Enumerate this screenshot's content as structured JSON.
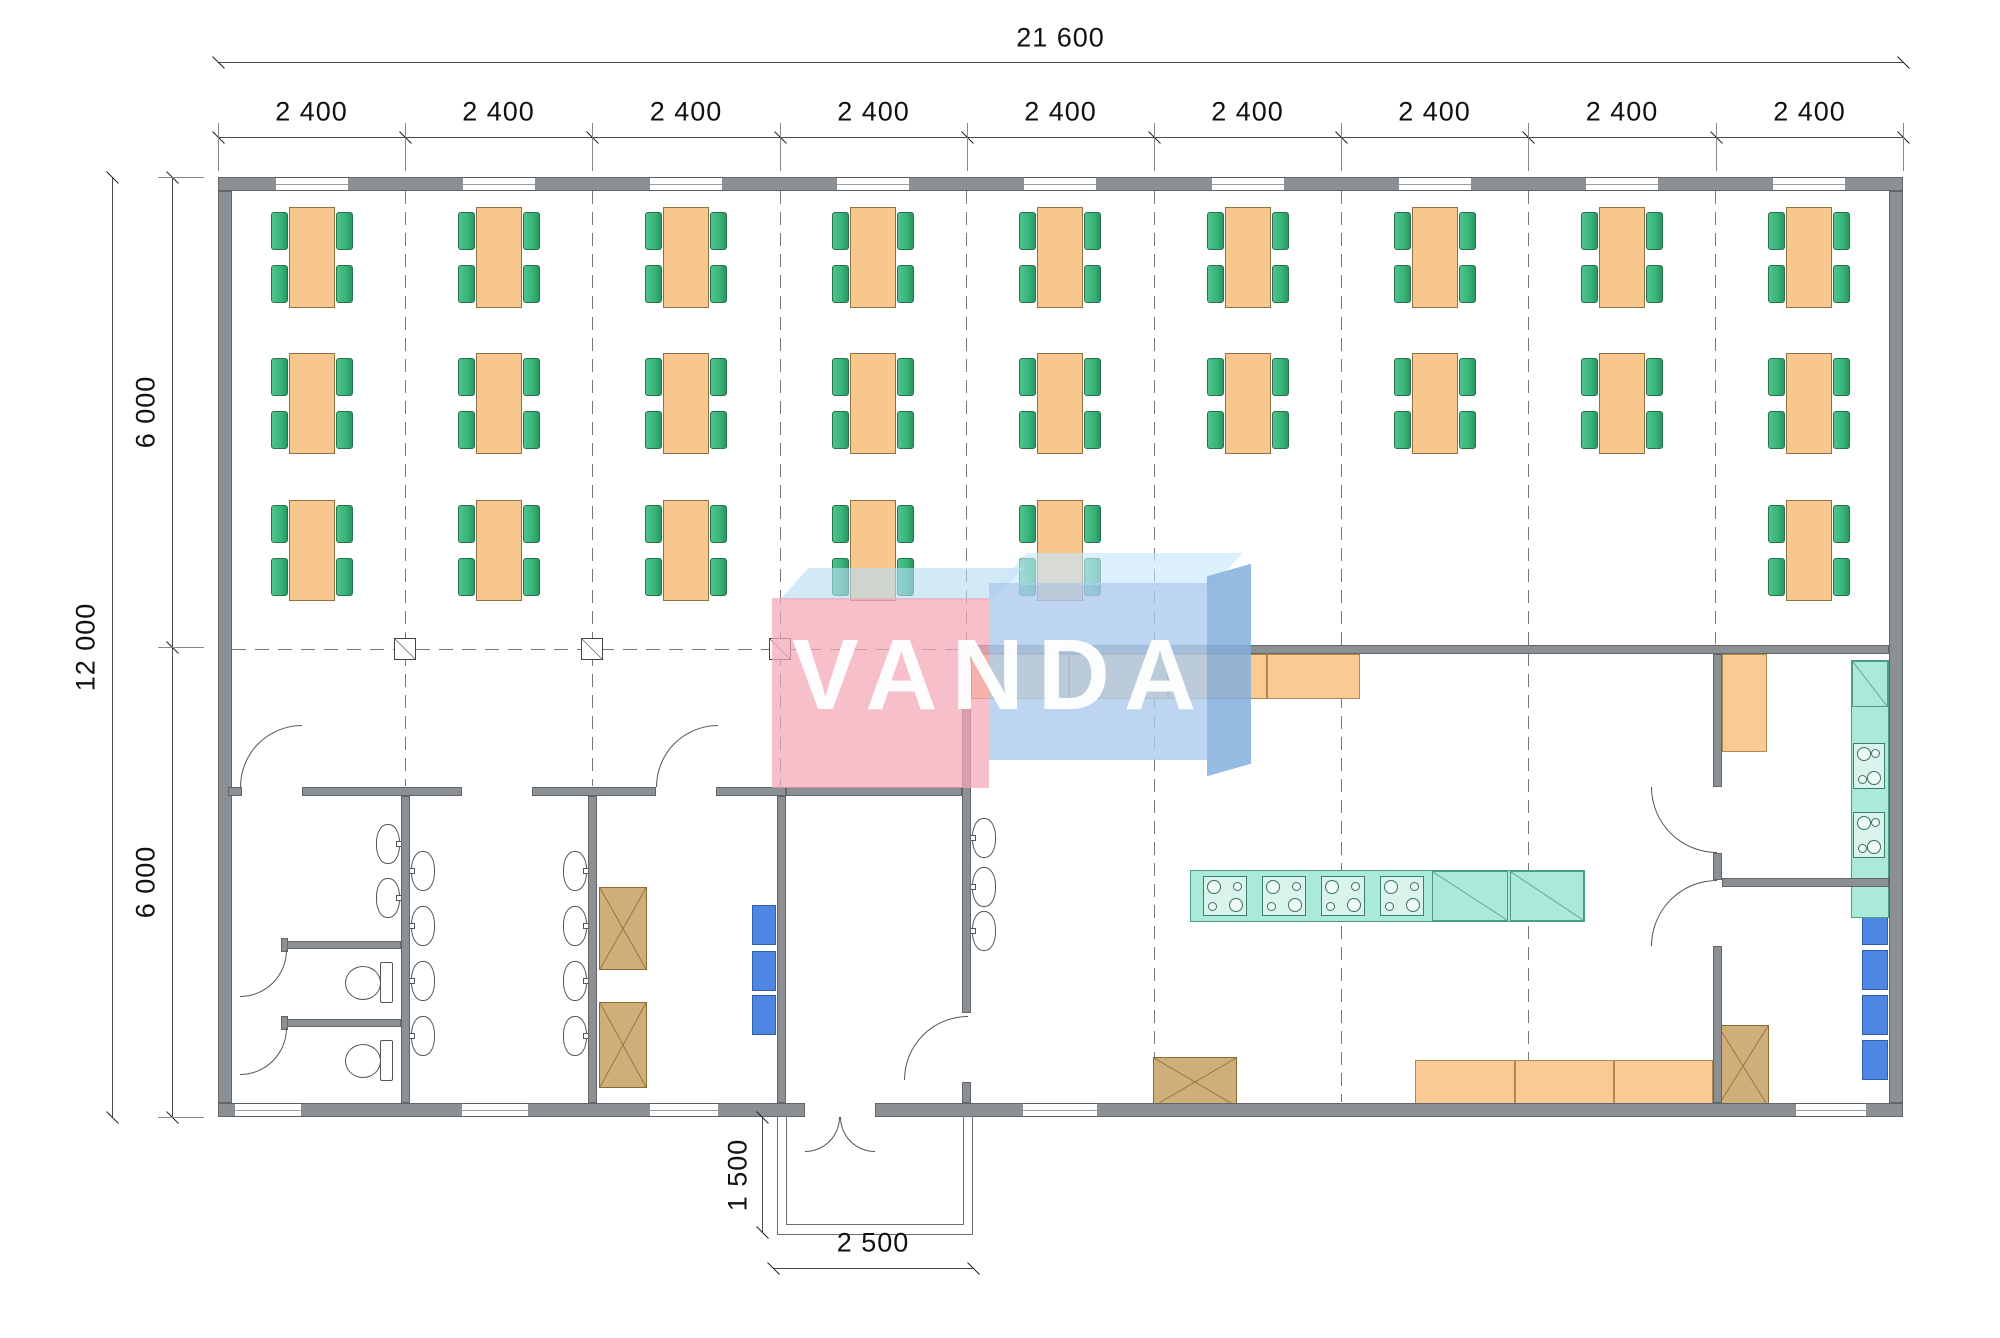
{
  "watermark": {
    "text": "VANDA"
  },
  "dimensions": {
    "total_width": "21 600",
    "bay_label": "2 400",
    "bay_labels": [
      "2 400",
      "2 400",
      "2 400",
      "2 400",
      "2 400",
      "2 400",
      "2 400",
      "2 400",
      "2 400"
    ],
    "total_height": "12 000",
    "half_labels": [
      "6 000",
      "6 000"
    ],
    "porch_depth": "1 500",
    "porch_width": "2 500"
  },
  "colors": {
    "wall": "#8b9094",
    "table": "#f7c78e",
    "chair": "#3bb57c",
    "teal": "#abe9d9",
    "cabinet": "#cfae79",
    "locker_blue": "#4f86e3",
    "counter": "#f9cb92",
    "watermark_pink": "#f2a6b6",
    "watermark_blue": "#adcbec"
  },
  "plan": {
    "walls": [
      [
        218,
        177,
        1685,
        14
      ],
      [
        218,
        1103,
        587,
        14
      ],
      [
        875,
        1103,
        1028,
        14
      ],
      [
        218,
        191,
        14,
        912
      ],
      [
        1889,
        191,
        14,
        912
      ],
      [
        962,
        645,
        927,
        9
      ],
      [
        228,
        787,
        14,
        9
      ],
      [
        302,
        787,
        160,
        9
      ],
      [
        532,
        787,
        124,
        9
      ],
      [
        716,
        787,
        70,
        9
      ],
      [
        786,
        787,
        176,
        9
      ],
      [
        401,
        796,
        9,
        307
      ],
      [
        588,
        796,
        9,
        307
      ],
      [
        777,
        796,
        9,
        307
      ],
      [
        962,
        654,
        9,
        359
      ],
      [
        962,
        1082,
        9,
        21
      ],
      [
        1713,
        654,
        9,
        133
      ],
      [
        1713,
        853,
        9,
        27
      ],
      [
        1713,
        946,
        9,
        157
      ],
      [
        1722,
        878,
        167,
        9
      ],
      [
        287,
        941,
        114,
        8
      ],
      [
        287,
        1019,
        114,
        8
      ],
      [
        281,
        938,
        7,
        14
      ],
      [
        281,
        1016,
        7,
        14
      ]
    ],
    "windows_top": {
      "centers": [
        312,
        499,
        686,
        873,
        1060,
        1248,
        1435,
        1622,
        1809
      ],
      "w": 72,
      "y": 177,
      "h": 14
    },
    "windows_bottom": [
      [
        235,
        1103,
        66
      ],
      [
        462,
        1103,
        66
      ],
      [
        650,
        1103,
        68
      ],
      [
        1023,
        1103,
        74
      ],
      [
        1796,
        1103,
        70
      ]
    ],
    "dashed_v": [
      {
        "x": 405,
        "y1": 191,
        "y2": 786
      },
      {
        "x": 592,
        "y1": 191,
        "y2": 786
      },
      {
        "x": 780,
        "y1": 191,
        "y2": 786
      },
      {
        "x": 966,
        "y1": 191,
        "y2": 644
      },
      {
        "x": 1154,
        "y1": 191,
        "y2": 1102
      },
      {
        "x": 1341,
        "y1": 191,
        "y2": 1102
      },
      {
        "x": 1528,
        "y1": 191,
        "y2": 1102
      },
      {
        "x": 1715,
        "y1": 191,
        "y2": 644
      }
    ],
    "dashed_h": {
      "y": 649,
      "x1": 232,
      "x2": 961
    },
    "columns": [
      405,
      592,
      780
    ],
    "tables": {
      "bay_centers": [
        312,
        499,
        686,
        873,
        1060,
        1248,
        1435,
        1622,
        1809
      ],
      "row_tops": [
        207,
        353,
        500
      ],
      "grid": [
        [
          1,
          1,
          1
        ],
        [
          1,
          1,
          1
        ],
        [
          1,
          1,
          1
        ],
        [
          1,
          1,
          1
        ],
        [
          1,
          1,
          1
        ],
        [
          1,
          1,
          0
        ],
        [
          1,
          1,
          0
        ],
        [
          1,
          1,
          0
        ],
        [
          1,
          1,
          1
        ]
      ],
      "table_w": 46,
      "table_h": 101,
      "chair_w": 17,
      "chair_h": 38
    },
    "sinks": [
      {
        "x": 376,
        "y": 824,
        "tap": "right"
      },
      {
        "x": 376,
        "y": 878,
        "tap": "right"
      },
      {
        "x": 411,
        "y": 851,
        "tap": "left"
      },
      {
        "x": 411,
        "y": 906,
        "tap": "left"
      },
      {
        "x": 411,
        "y": 961,
        "tap": "left"
      },
      {
        "x": 411,
        "y": 1016,
        "tap": "left"
      },
      {
        "x": 563,
        "y": 851,
        "tap": "right"
      },
      {
        "x": 563,
        "y": 906,
        "tap": "right"
      },
      {
        "x": 563,
        "y": 961,
        "tap": "right"
      },
      {
        "x": 563,
        "y": 1016,
        "tap": "right"
      },
      {
        "x": 972,
        "y": 818,
        "tap": "left"
      },
      {
        "x": 972,
        "y": 867,
        "tap": "left"
      },
      {
        "x": 972,
        "y": 911,
        "tap": "left"
      }
    ],
    "toilets": [
      {
        "x": 345,
        "y": 963
      },
      {
        "x": 345,
        "y": 1041
      }
    ],
    "x_cabinets": [
      [
        599,
        887,
        48,
        83
      ],
      [
        599,
        1002,
        48,
        86
      ],
      [
        1153,
        1057,
        84,
        50
      ],
      [
        1717,
        1025,
        52,
        82
      ]
    ],
    "blue_units": [
      [
        752,
        905,
        24,
        40
      ],
      [
        752,
        951,
        24,
        40
      ],
      [
        752,
        995,
        24,
        40
      ],
      [
        1862,
        905,
        26,
        40
      ],
      [
        1862,
        950,
        26,
        40
      ],
      [
        1862,
        995,
        26,
        40
      ],
      [
        1862,
        1040,
        26,
        40
      ]
    ],
    "counters": [
      {
        "x": 971,
        "y": 654,
        "w": 389,
        "h": 45,
        "dividers": [
          1068,
          1167,
          1266
        ],
        "vdiv": true
      },
      {
        "x": 1415,
        "y": 1060,
        "w": 298,
        "h": 47,
        "dividers": [
          1514,
          1613
        ],
        "vdiv": true
      },
      {
        "x": 1722,
        "y": 654,
        "w": 45,
        "h": 98,
        "dividers": [],
        "vdiv": false
      }
    ],
    "island": {
      "x": 1190,
      "y": 870,
      "w": 395,
      "h": 52,
      "stoves": [
        1203,
        1262,
        1321,
        1380
      ],
      "stove_w": 44,
      "stove_h": 40,
      "stove_y": 876,
      "diag": [
        [
          1432,
          76
        ],
        [
          1510,
          74
        ]
      ]
    },
    "right_strip": {
      "x": 1851,
      "y": 660,
      "w": 38,
      "h": 198,
      "diag_h": 46,
      "stoves": [
        {
          "y": 743,
          "h": 46
        },
        {
          "y": 812,
          "h": 46
        }
      ]
    },
    "doors": [
      {
        "x": 240,
        "y": 725,
        "r": 62,
        "corner": "tl"
      },
      {
        "x": 656,
        "y": 725,
        "r": 62,
        "corner": "tl"
      },
      {
        "x": 240,
        "y": 950,
        "r": 47,
        "corner": "br"
      },
      {
        "x": 240,
        "y": 1028,
        "r": 47,
        "corner": "br"
      },
      {
        "x": 904,
        "y": 1016,
        "r": 64,
        "corner": "tl"
      },
      {
        "x": 1651,
        "y": 787,
        "r": 66,
        "corner": "bl"
      },
      {
        "x": 1651,
        "y": 880,
        "r": 66,
        "corner": "tl"
      },
      {
        "x": 805,
        "y": 1117,
        "r": 35,
        "corner": "br"
      },
      {
        "x": 840,
        "y": 1117,
        "r": 35,
        "corner": "bl"
      }
    ],
    "porch": {
      "outer": [
        777,
        1117,
        196,
        118
      ],
      "inner": [
        786,
        1117,
        178,
        108
      ]
    },
    "dims": {
      "top1": {
        "y": 62,
        "x1": 218,
        "x2": 1903,
        "label_y": 38
      },
      "top2": {
        "y": 137,
        "xs": [
          218,
          405,
          592,
          780,
          967,
          1154,
          1341,
          1528,
          1716,
          1903
        ],
        "label_y": 112
      },
      "left1": {
        "x": 112,
        "y1": 177,
        "y2": 1117
      },
      "left2": {
        "x": 172,
        "ys": [
          177,
          647,
          1117
        ]
      },
      "porchV": {
        "x": 762,
        "y1": 1117,
        "y2": 1232
      },
      "porchH": {
        "y": 1268,
        "x1": 773,
        "x2": 973,
        "label_y": 1243
      }
    }
  }
}
